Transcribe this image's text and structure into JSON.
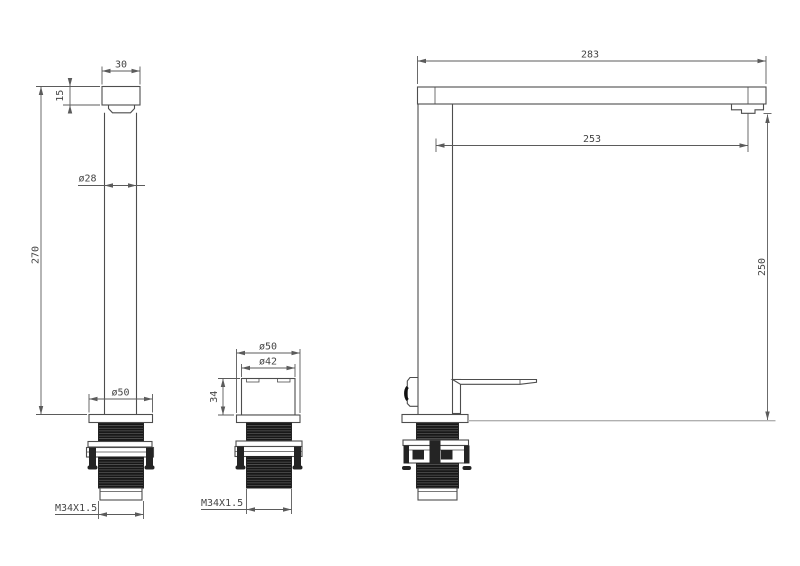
{
  "palette": {
    "background": "#ffffff",
    "line": "#4d4d4d",
    "dimension_line": "#5b5b5b",
    "text": "#454545",
    "thread_fill": "#161616",
    "counter_line": "#b0b0b0"
  },
  "views": {
    "front": {
      "dims": {
        "spout_width": "30",
        "spout_cap_height": "15",
        "overall_height": "270",
        "body_diameter": "ø28",
        "base_diameter": "ø50",
        "thread_spec": "M34X1.5"
      }
    },
    "shank": {
      "dims": {
        "flange_diameter": "ø50",
        "body_diameter": "ø42",
        "body_height": "34",
        "thread_spec": "M34X1.5"
      }
    },
    "side": {
      "dims": {
        "overall_reach": "283",
        "spout_reach": "253",
        "spout_height": "250"
      }
    }
  }
}
